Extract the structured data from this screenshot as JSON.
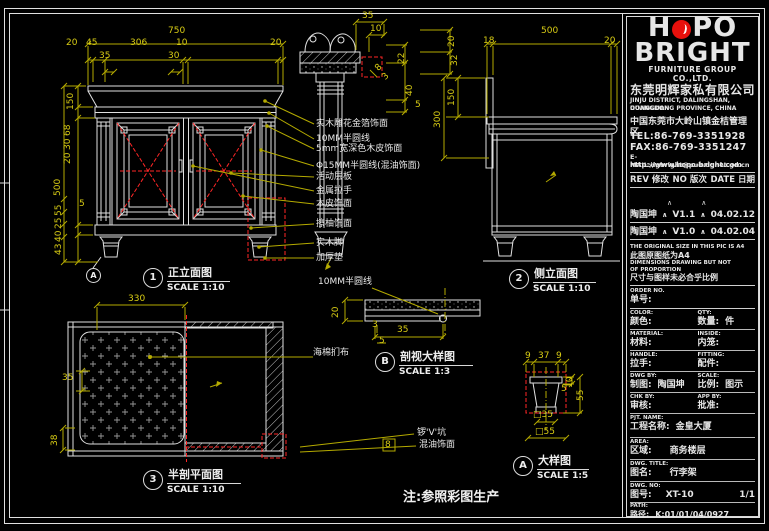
{
  "colors": {
    "bg": "#000000",
    "line": "#e0e0e0",
    "dim_yellow": "#b4aa00",
    "red": "#ff2626",
    "logo_red": "#e8100c"
  },
  "logo": {
    "h": "H",
    "po": "PO",
    "brand": "BRIGHT",
    "sub": "FURNITURE GROUP CO.,LTD.",
    "cn": "东莞明辉家私有限公司"
  },
  "contact": {
    "addr1": "JINJU DISTRICT, DALINGSHAN, DONGGUAN",
    "addr2": "GUANGDONG PROVINCE, CHINA",
    "addr3": "中国东莞市大岭山镇金桔管理区",
    "tel": "TEL:86-769-3351928",
    "fax": "FAX:86-769-3351247",
    "email": "E-MAIL:dgbright@pub.dgnet.gd.cn",
    "web": "http://www.hopo-bright.com"
  },
  "revision": {
    "header": {
      "rev": "REV 修改",
      "no": "NO 版次",
      "date": "DATE 日期"
    },
    "caret": "∧",
    "rows": [
      {
        "name": "陶国坤",
        "ver": "V1.1",
        "date": "04.02.12"
      },
      {
        "name": "陶国坤",
        "ver": "V1.0",
        "date": "04.02.04"
      }
    ]
  },
  "notice": {
    "l1": "THE ORIGINAL SIZE IN THIS PIC IS A4",
    "l2": "此图原图纸为A4",
    "l3": "DIMENSIONS DRAWING BUT NOT",
    "l4": "OF PROPORTION",
    "l5": "尺寸与图样未必合乎比例"
  },
  "order": {
    "en": "ORDER NO.",
    "cn": "单号:"
  },
  "fields": {
    "color": {
      "en": "COLOR:",
      "cn": "颜色:",
      "val": ""
    },
    "qty": {
      "en": "QTY:",
      "cn": "数量:",
      "val": "件"
    },
    "material": {
      "en": "MATERIAL:",
      "cn": "材料:",
      "val": ""
    },
    "inside": {
      "en": "INSIDE:",
      "cn": "内笼:",
      "val": ""
    },
    "handle": {
      "en": "HANDLE:",
      "cn": "拉手:",
      "val": ""
    },
    "fitting": {
      "en": "FITTING:",
      "cn": "配件:",
      "val": ""
    },
    "dwgby": {
      "en": "DWG BY:",
      "cn": "制图:",
      "val": "陶国坤"
    },
    "scale": {
      "en": "SCALE:",
      "cn": "比例:",
      "val": "图示"
    },
    "chkby": {
      "en": "CHK BY:",
      "cn": "审核:",
      "val": ""
    },
    "appby": {
      "en": "APP BY:",
      "cn": "批准:",
      "val": ""
    },
    "pjt": {
      "en": "PJT. NAME:",
      "cn": "工程名称:",
      "val": "金皇大厦"
    },
    "area": {
      "en": "AREA:",
      "cn": "区域:",
      "val": "商务楼层"
    },
    "title": {
      "en": "DWG. TITLE:",
      "cn": "图名:",
      "val": "行李架"
    },
    "no": {
      "en": "DWG. NO:",
      "cn": "图号:",
      "val": "XT-10",
      "page": "1/1"
    },
    "path": {
      "en": "PATH:",
      "cn": "路径:",
      "val": "K:01/01/04/0927"
    }
  },
  "views": {
    "front": {
      "num": "1",
      "title": "正立面图",
      "scale": "SCALE 1:10"
    },
    "side": {
      "num": "2",
      "title": "侧立面图",
      "scale": "SCALE 1:10"
    },
    "plan": {
      "num": "3",
      "title": "半剖平面图",
      "scale": "SCALE 1:10"
    },
    "secb": {
      "num": "B",
      "title": "剖视大样图",
      "scale": "SCALE 1:3"
    },
    "deta": {
      "num": "A",
      "title": "大样图",
      "scale": "SCALE 1:5"
    },
    "marker_a": "A"
  },
  "callouts": [
    "实木雕花金箔饰面",
    "10MM半圆线",
    "5mm宽深色木皮饰面",
    "Φ15MM半圆线(混油饰面)",
    "活动层板",
    "金属拉手",
    "木皮饰面",
    "擦柚饰面",
    "实木脚",
    "加厚垫"
  ],
  "detail_labels": {
    "b1": "10MM半圆线",
    "b2": "海棉扪布",
    "a1": "锣'V'坑",
    "a2": "混油饰面"
  },
  "note": "注:参照彩图生产",
  "dims": {
    "front_w": "750",
    "front_top": [
      "20",
      "45",
      "306",
      "10",
      "20"
    ],
    "front_top2": [
      "35",
      "30"
    ],
    "front_left": [
      "150",
      "68",
      "30",
      "20",
      "500",
      "5",
      "55",
      "25",
      "40",
      "43"
    ],
    "crown_top": [
      "35",
      "10"
    ],
    "crown_right": [
      "20",
      "22",
      "32",
      "40",
      "5"
    ],
    "crown_mid": [
      "8",
      "3"
    ],
    "side_w": "500",
    "side_top": [
      "18",
      "20"
    ],
    "side_left": [
      "300",
      "150"
    ],
    "plan_w": "330",
    "plan_left": [
      "35",
      "38"
    ],
    "b_dims": [
      "20",
      "3",
      "35",
      "5"
    ],
    "a_top": [
      "9",
      "37",
      "9"
    ],
    "a_right": [
      "10",
      "5",
      "55"
    ],
    "a_bottom": [
      "□35",
      "□55"
    ],
    "a_groove": "8"
  }
}
